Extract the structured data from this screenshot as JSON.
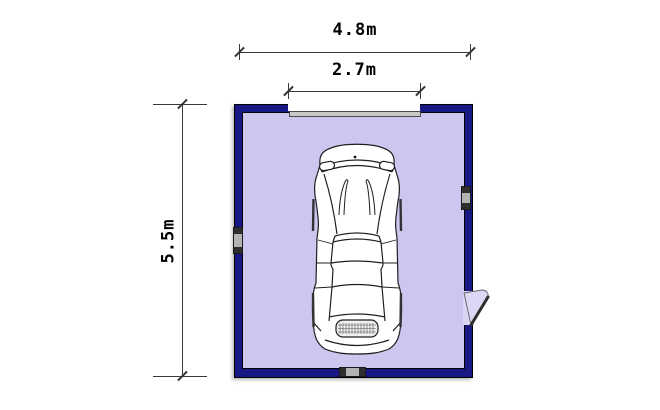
{
  "plan": {
    "title": "Single garage floor plan",
    "dimensions": {
      "overall_width": {
        "label": "4.8m"
      },
      "door_opening": {
        "label": "2.7m"
      },
      "overall_depth": {
        "label": "5.5m"
      }
    },
    "colors": {
      "wall": "#181884",
      "floor": "#cdc7ef",
      "garage_door": "#c9c9c9",
      "dim_line": "#3a3a3a"
    },
    "features": {
      "garage_door": "top-center-opening",
      "side_door": "right-wall-lower-swing-out",
      "window_left": "left-wall-center",
      "window_right": "right-wall-upper",
      "vent_bottom": "bottom-wall-center",
      "car": "car-top-view"
    }
  }
}
